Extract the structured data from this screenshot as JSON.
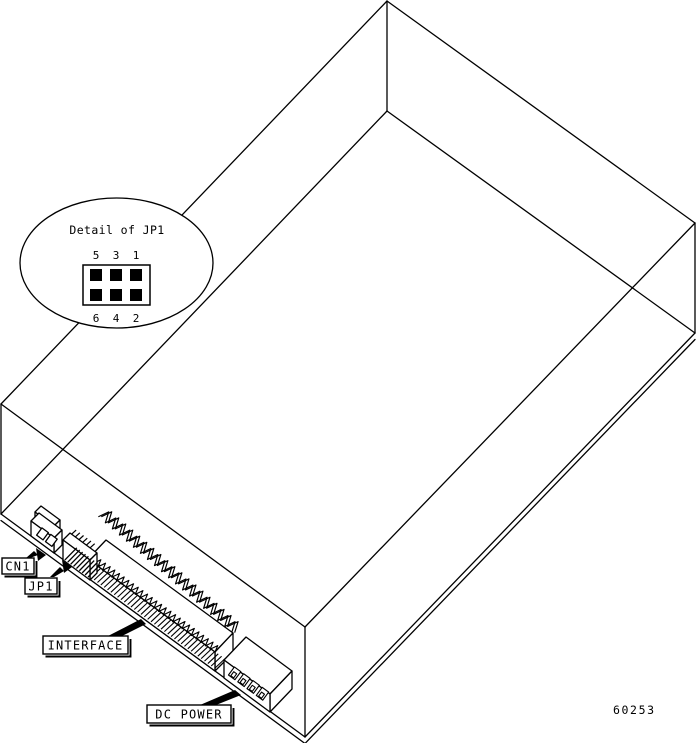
{
  "figure": {
    "number": "60253"
  },
  "callout": {
    "title": "Detail of JP1",
    "pins_top": [
      "5",
      "3",
      "1"
    ],
    "pins_bottom": [
      "6",
      "4",
      "2"
    ]
  },
  "labels": {
    "cn1": "CN1",
    "jp1": "JP1",
    "interface": "INTERFACE",
    "dc_power": "DC POWER"
  },
  "colors": {
    "line": "#000000",
    "background": "#ffffff"
  }
}
